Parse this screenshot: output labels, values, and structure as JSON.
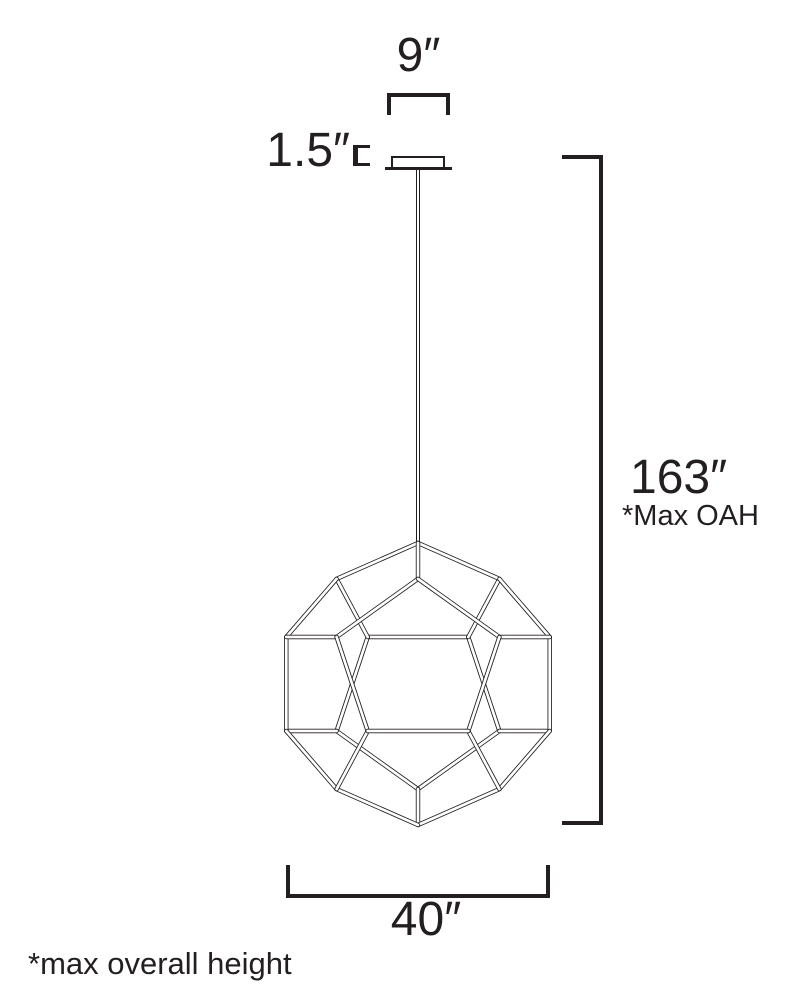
{
  "drawing": {
    "line_color": "#231f20",
    "background": "#ffffff",
    "fixture_shape": "dodecahedron-wireframe-pendant",
    "labels": {
      "canopy_width": "9″",
      "canopy_height": "1.5″",
      "overall_height": "163″",
      "overall_height_note": "*Max OAH",
      "fixture_width": "40″",
      "footnote": "*max overall height"
    }
  }
}
